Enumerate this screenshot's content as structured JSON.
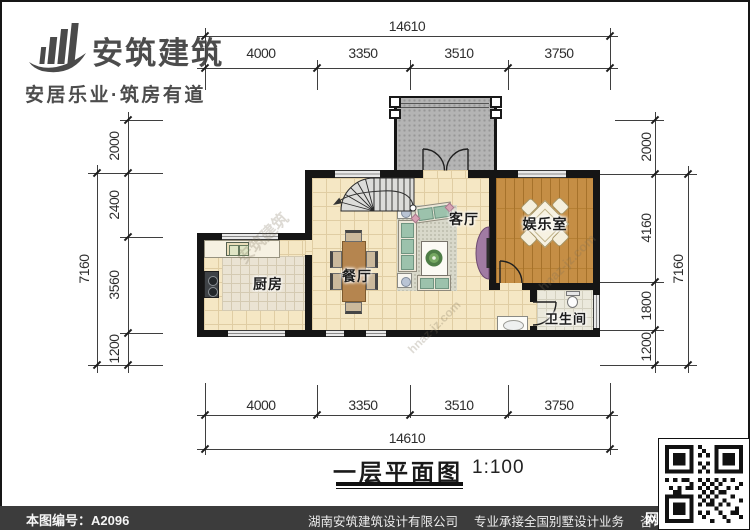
{
  "brand": {
    "name": "安筑建筑",
    "tagline": "安居乐业·筑房有道"
  },
  "plan": {
    "title": "一层平面图",
    "scale": "1:100",
    "rooms": {
      "living": "客厅",
      "dining": "餐厅",
      "kitchen": "厨房",
      "entertainment": "娱乐室",
      "bathroom": "卫生间"
    }
  },
  "dimensions": {
    "top": {
      "total": "14610",
      "segments": [
        "4000",
        "3350",
        "3510",
        "3750"
      ]
    },
    "bottom": {
      "total": "14610",
      "segments": [
        "4000",
        "3350",
        "3510",
        "3750"
      ]
    },
    "left": {
      "total": "7160",
      "segments": [
        "2000",
        "2400",
        "3560",
        "1200"
      ]
    },
    "right": {
      "total": "7160",
      "segments": [
        "2000",
        "4160",
        "1800",
        "1200"
      ]
    }
  },
  "footer": {
    "sheet_no": "本图编号：A2096",
    "company": "湖南安筑建筑设计有限公司",
    "service": "专业承接全国别墅设计业务",
    "phone": "咨询电话：400-8070-511",
    "web": "网"
  },
  "watermarks": [
    "安筑建筑",
    "hnaz-jz.com",
    "hnaz-jz.com"
  ],
  "colors": {
    "wall": "#151515",
    "floor_tile": "#f5e7c4",
    "wood_floor": "#c58e45",
    "porch": "#b4b4b4",
    "door_accent": "#a17ba3",
    "footer_bg": "#3c3c3c"
  }
}
